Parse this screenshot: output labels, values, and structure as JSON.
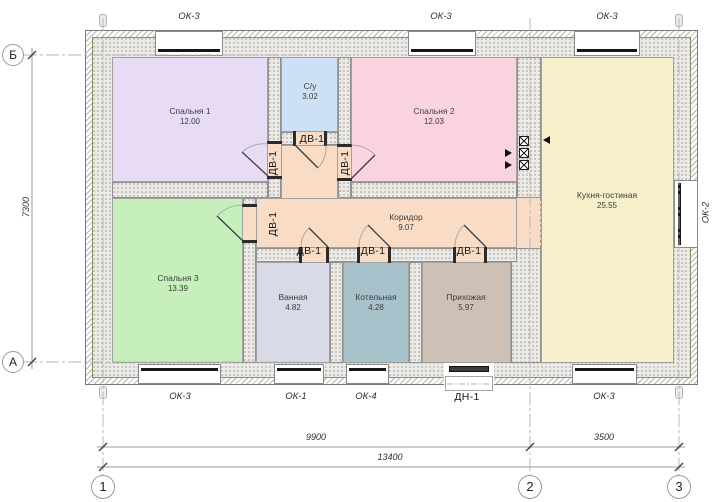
{
  "title": "floor-plan",
  "axes": {
    "row_top": "Б",
    "row_bottom": "А",
    "col_1": "1",
    "col_2": "2",
    "col_3": "3"
  },
  "dimensions": {
    "left_vertical": "7300",
    "bottom_span_1_2": "9900",
    "bottom_span_2_3": "3500",
    "bottom_total": "13400"
  },
  "rooms": [
    {
      "name": "Спальня 1",
      "area": "12.00",
      "color": "#e7dcf3"
    },
    {
      "name": "С/у",
      "area": "3.02",
      "color": "#cde0f6"
    },
    {
      "name": "Спальня 2",
      "area": "12.03",
      "color": "#f9d3e0"
    },
    {
      "name": "Кухня-гостиная",
      "area": "25.55",
      "color": "#f7f0ca"
    },
    {
      "name": "Спальня 3",
      "area": "13.39",
      "color": "#c7efbc"
    },
    {
      "name": "Ванная",
      "area": "4.82",
      "color": "#d8dae7"
    },
    {
      "name": "Котельная",
      "area": "4.28",
      "color": "#a8c2cc"
    },
    {
      "name": "Прихожая",
      "area": "5.97",
      "color": "#cec0b4"
    },
    {
      "name": "Коридор",
      "area": "9.07",
      "color": "#f9dcc5"
    }
  ],
  "openings": {
    "window_labels_top": [
      "ОК-3",
      "ОК-3",
      "ОК-3"
    ],
    "window_labels_bottom": [
      "ОК-3",
      "ОК-1",
      "ОК-4",
      "ОК-3"
    ],
    "right_window_label": "ОК-2",
    "entry_door_label": "ДН-1",
    "interior_door_label": "ДВ-1"
  },
  "colors": {
    "wall_fill": "#edebe7",
    "wall_speckle": "#a8a59d",
    "hatch_line": "#b2b2b2",
    "insulation_line": "#8f8f62",
    "line": "#444444",
    "grid_line": "#b3b3b3",
    "glazing": "#161616"
  },
  "icons": {
    "vent_duct": "vent-duct-icon",
    "vent_arrow": "vent-arrow-icon"
  }
}
